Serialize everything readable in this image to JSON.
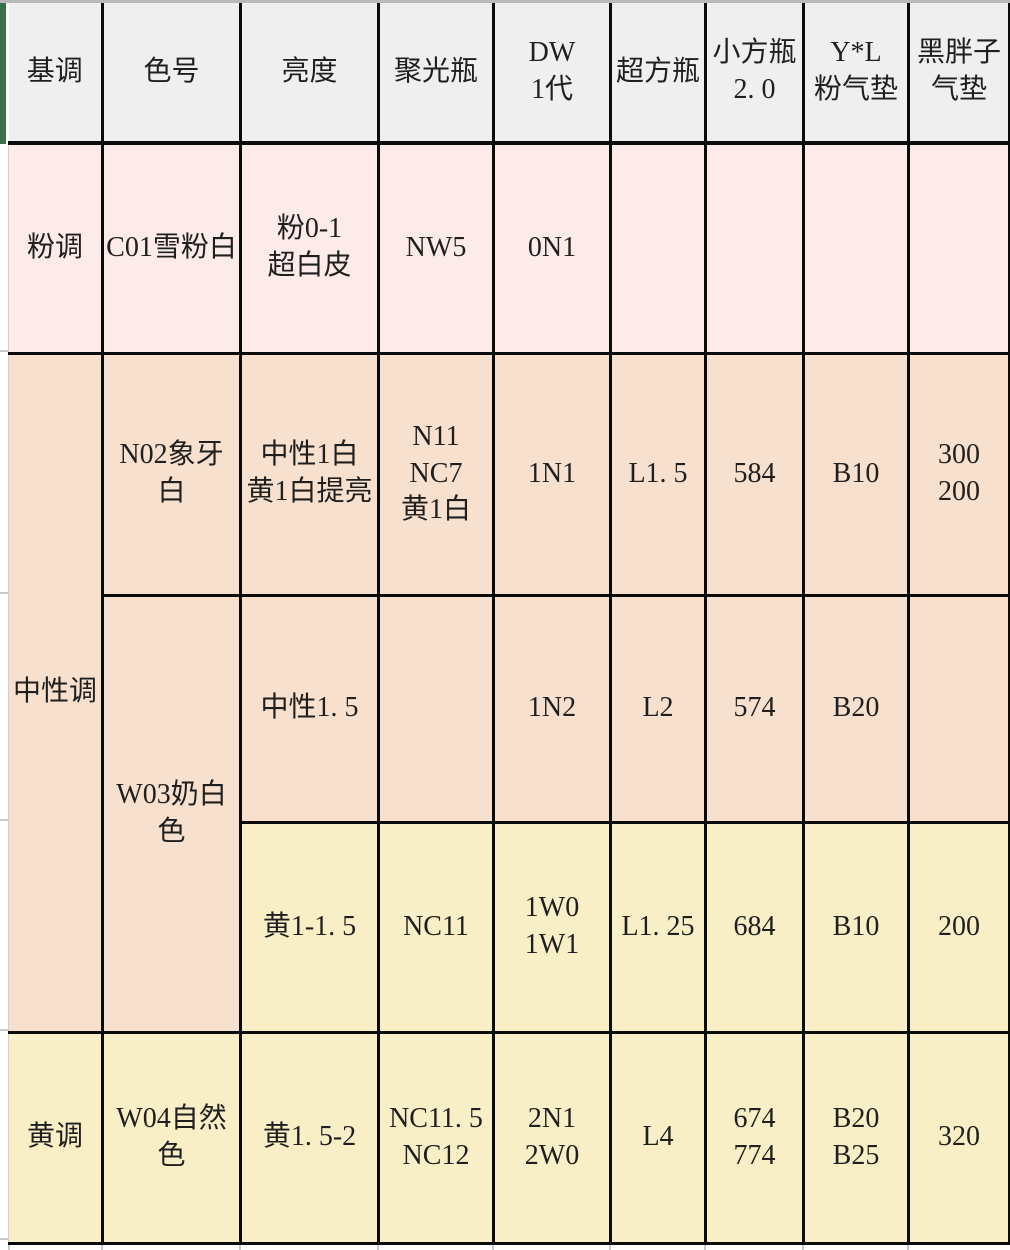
{
  "colors": {
    "header_bg": "#f0eff0",
    "pink_row": "#fcebe9",
    "peach_row": "#f7e0cd",
    "yellow_row": "#f9efc6",
    "grid_border": "#0b0b0b",
    "header_side_strip_green": "#3e7050",
    "top_edge_line": "#b9b9b9"
  },
  "table": {
    "header": [
      "基调",
      "色号",
      "亮度",
      "聚光瓶",
      "DW\n1代",
      "超方瓶",
      "小方瓶\n2. 0",
      "Y*L\n粉气垫",
      "黑胖子\n气垫"
    ],
    "rows": [
      [
        "粉调",
        "C01雪粉白",
        "粉0-1\n超白皮",
        "NW5",
        "0N1",
        "",
        "",
        "",
        ""
      ],
      [
        "中性调",
        "N02象牙白",
        "中性1白\n黄1白提亮",
        "N11\nNC7\n黄1白",
        "1N1",
        "L1. 5",
        "584",
        "B10",
        "300\n200"
      ],
      [
        "W03奶白色",
        "中性1. 5",
        "",
        "1N2",
        "L2",
        "574",
        "B20",
        ""
      ],
      [
        "黄1-1. 5",
        "NC11",
        "1W0\n1W1",
        "L1. 25",
        "684",
        "B10",
        "200"
      ],
      [
        "黄调",
        "W04自然色",
        "黄1. 5-2",
        "NC11. 5\nNC12",
        "2N1\n2W0",
        "L4",
        "674\n774",
        "B20\nB25",
        "320"
      ]
    ]
  }
}
